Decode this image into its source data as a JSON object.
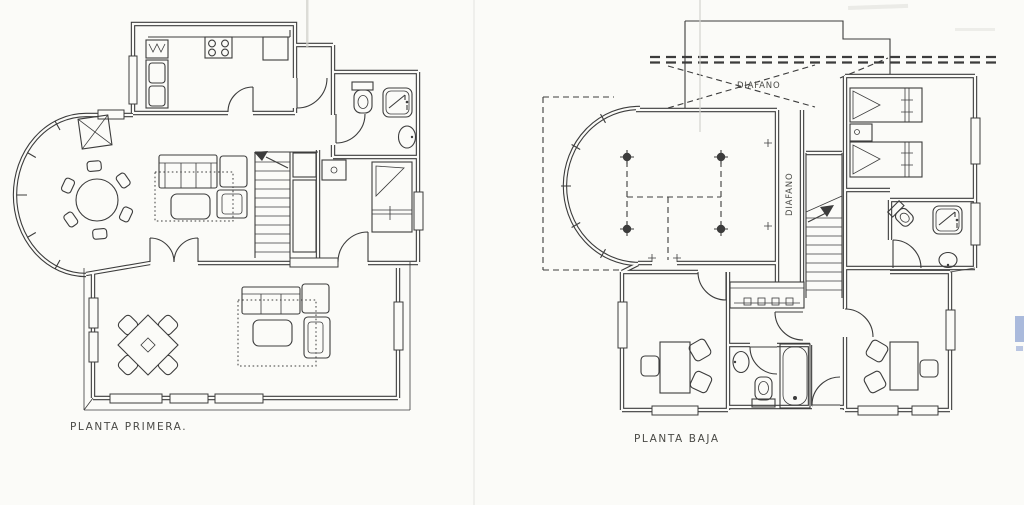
{
  "sheet": {
    "background": "#fbfbf8",
    "ink": "#3c3c3c",
    "artifact_blue": "#5a79c0"
  },
  "plans": {
    "primera": {
      "label": "PLANTA PRIMERA."
    },
    "baja": {
      "label": "PLANTA BAJA",
      "annotations": {
        "diafano_upper": "DIAFANO",
        "diafano_corridor": "DIAFANO"
      }
    }
  }
}
